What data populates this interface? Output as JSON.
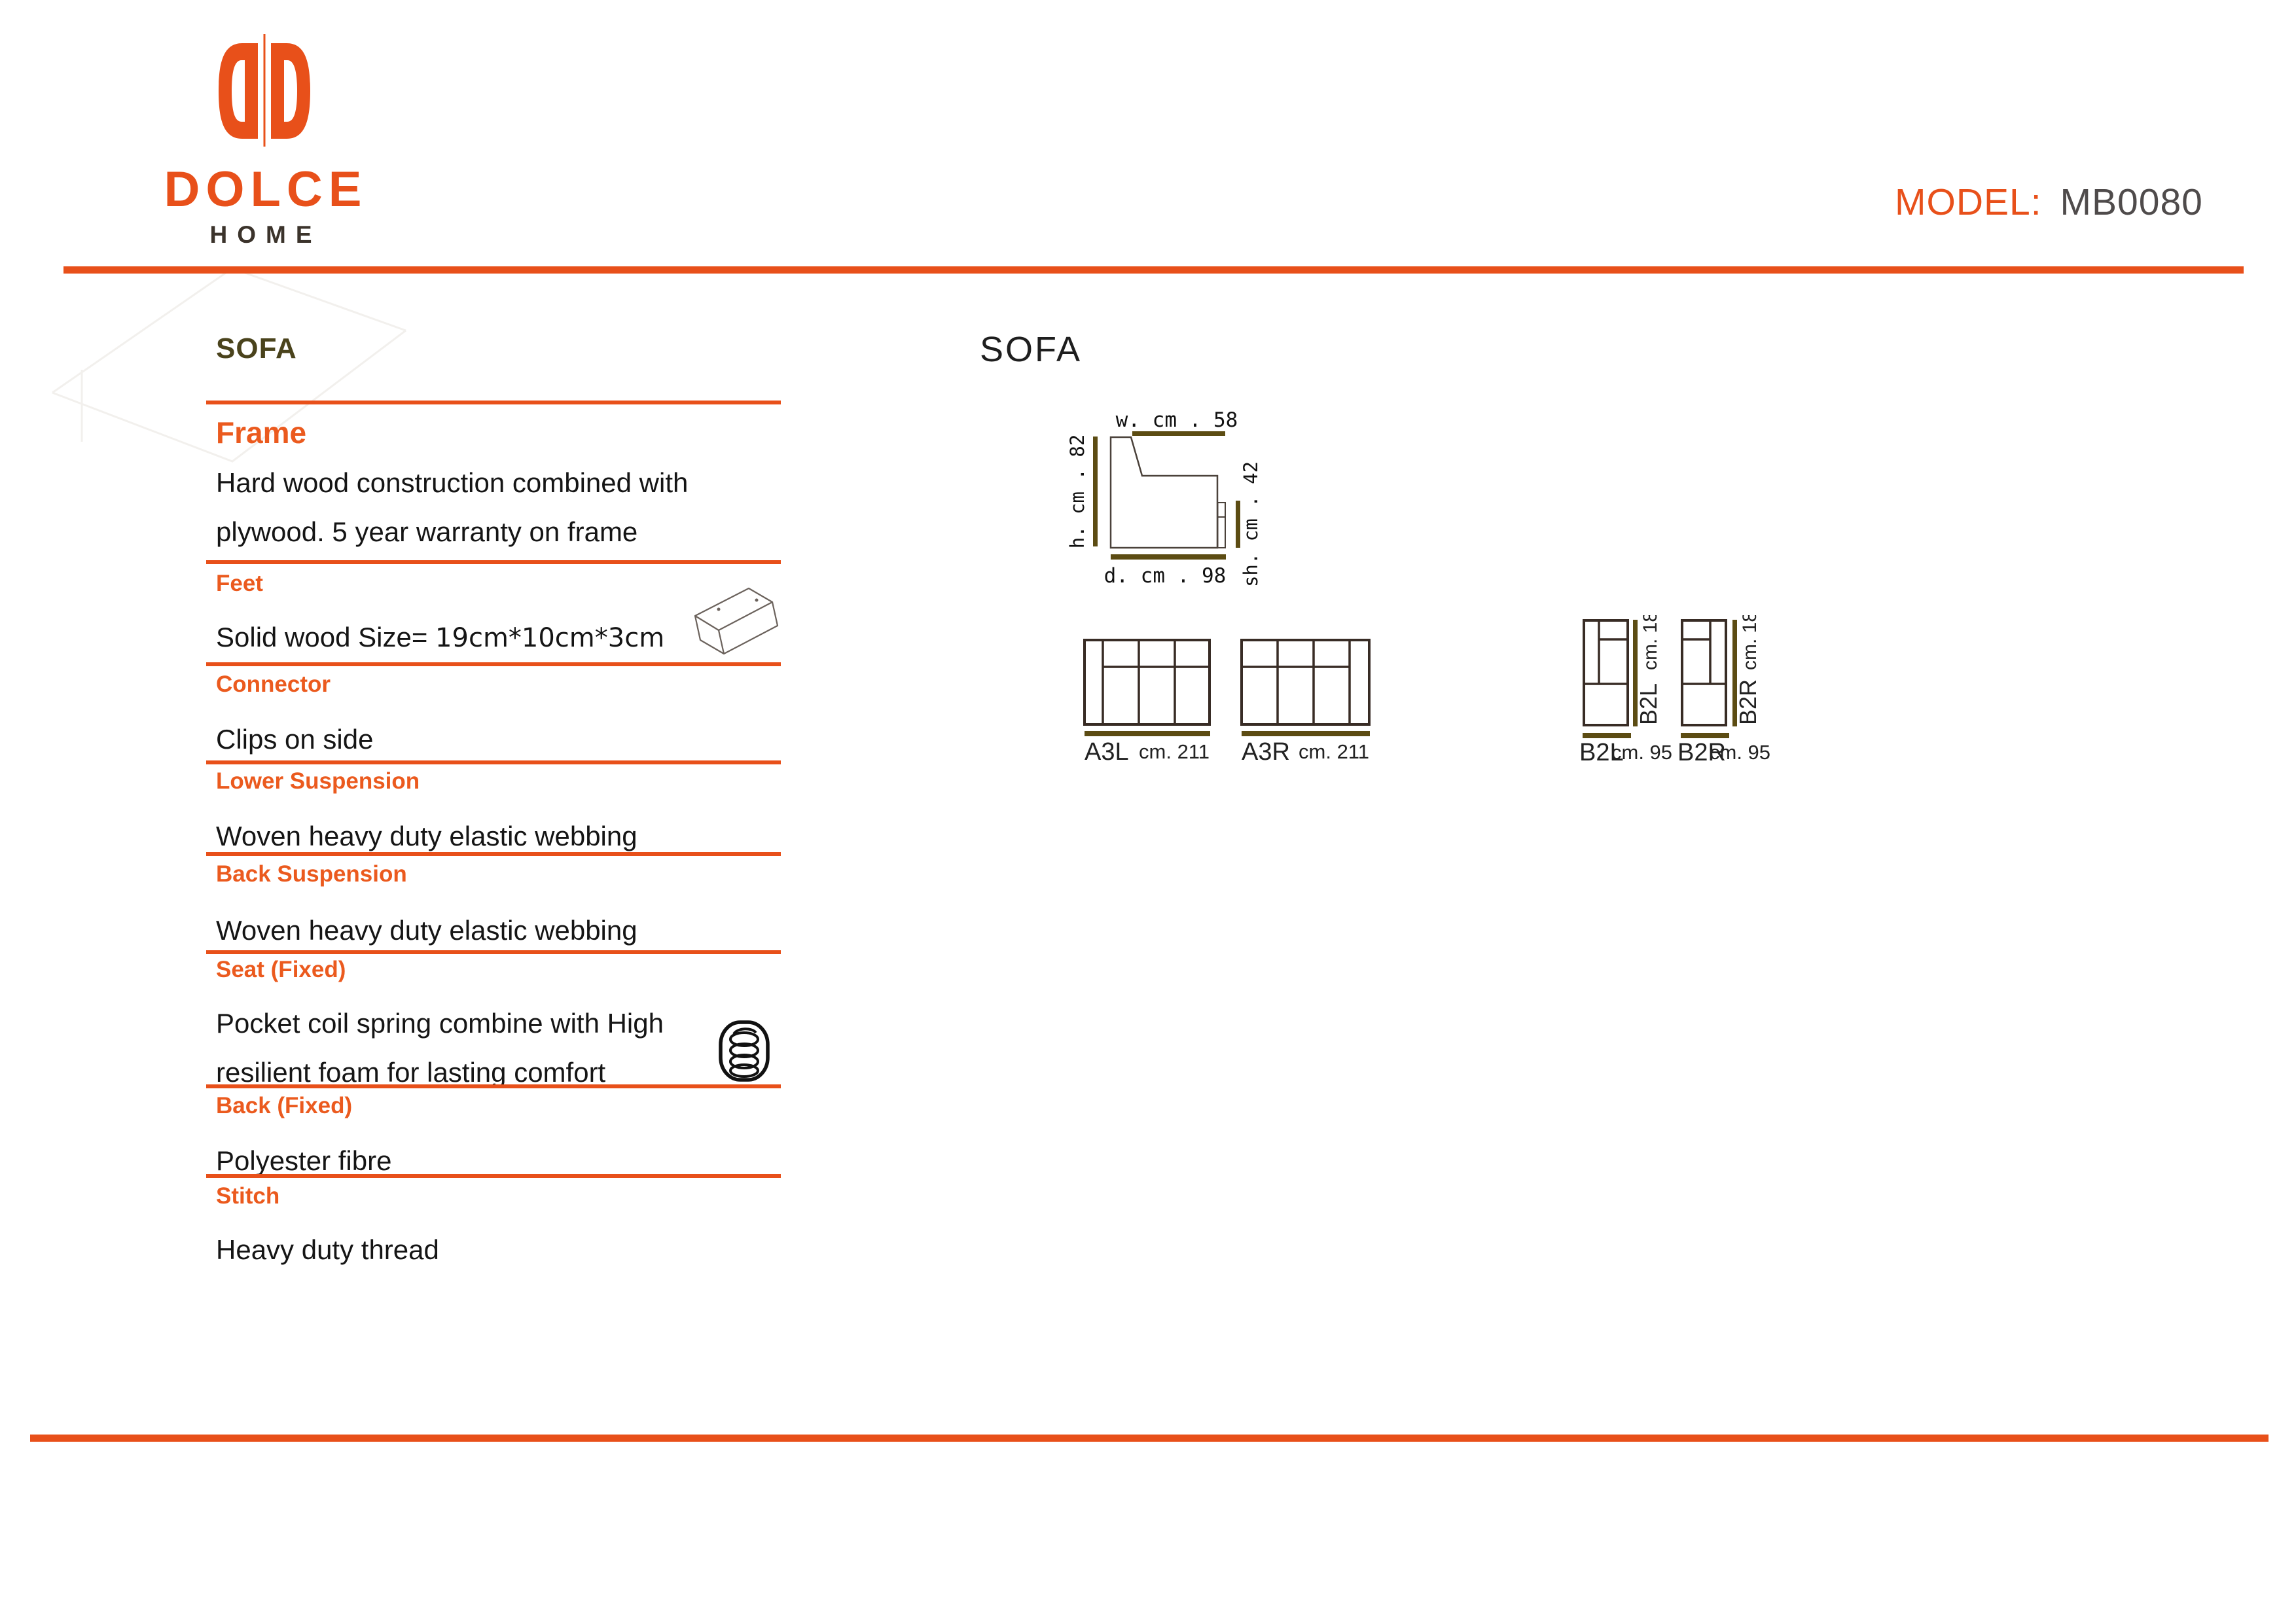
{
  "brand": {
    "name": "DOLCE",
    "sub": "HOME"
  },
  "model": {
    "label": "MODEL:",
    "value": "MB0080"
  },
  "colors": {
    "accent_orange": "#E8501A",
    "heading_orange": "#EB5A1E",
    "olive_bar": "#5C4C13",
    "olive_title": "#4A431C",
    "diagram_line": "#382C25",
    "model_value_gray": "#4F4B4B"
  },
  "icons": {
    "logo": "dolce-double-d-logo",
    "feet": "wood-block-icon",
    "seat": "coil-spring-icon"
  },
  "left_panel": {
    "title": "SOFA",
    "sections": [
      {
        "heading": "Frame",
        "body_line1": "Hard wood construction combined with",
        "body_line2": "plywood. 5 year warranty on frame"
      },
      {
        "heading": "Feet",
        "body_prefix": "Solid wood Size=",
        "body_value": "19cm*10cm*3cm"
      },
      {
        "heading": "Connector",
        "body": "Clips on side"
      },
      {
        "heading": "Lower Suspension",
        "body": "Woven heavy duty elastic webbing"
      },
      {
        "heading": "Back Suspension",
        "body": "Woven heavy duty elastic webbing"
      },
      {
        "heading": "Seat (Fixed)",
        "body_line1": "Pocket coil spring combine with High",
        "body_line2": "resilient foam for lasting comfort"
      },
      {
        "heading": "Back (Fixed)",
        "body": "Polyester fibre"
      },
      {
        "heading": "Stitch",
        "body": "Heavy duty thread"
      }
    ]
  },
  "diagram_panel": {
    "title": "SOFA",
    "side_view": {
      "width_label": "w. cm . 58",
      "height_label": "h. cm . 82",
      "seat_height_label": "sh. cm . 42",
      "depth_label": "d. cm . 98"
    },
    "modules": [
      {
        "code": "A3L",
        "size_label": "cm. 211"
      },
      {
        "code": "A3R",
        "size_label": "cm. 211"
      },
      {
        "code": "B2L",
        "size_label": "cm. 95",
        "depth_label": "cm. 181"
      },
      {
        "code": "B2R",
        "size_label": "cm. 95",
        "depth_label": "cm. 181"
      }
    ]
  }
}
